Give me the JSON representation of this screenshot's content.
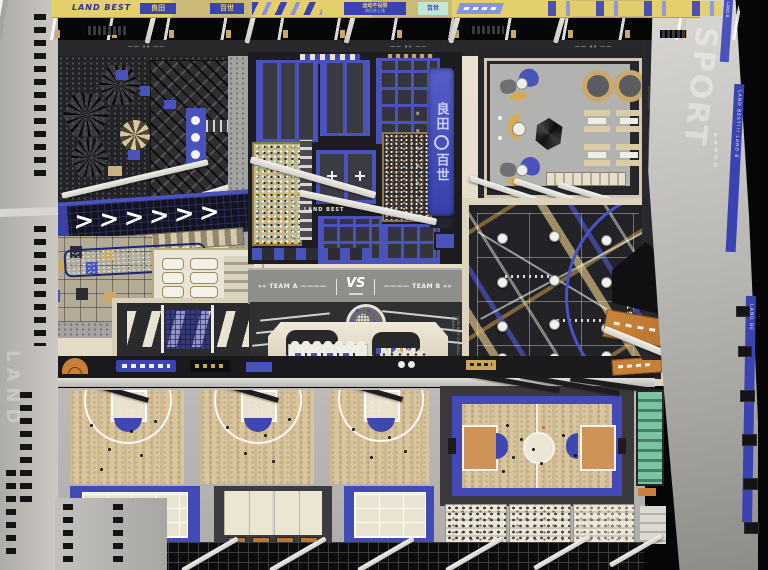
{
  "palette": {
    "accent_blue": "#4a52bc",
    "banner_yellow": "#e3cf6b",
    "dark": "#232327",
    "beige": "#e7dfcb",
    "wood": "#d9c69e",
    "concrete": "#b7b6b4",
    "wall_grey": "#c6c4c0",
    "court_blue": "#434ab8",
    "key_orange": "#cf9257",
    "mat_green": "#7cc4a0",
    "led_navy": "#13131d"
  },
  "ceiling": {
    "brand": "LAND BEST",
    "sign_liangtian": "良田",
    "sign_baishi": "百世",
    "slogan_main": "运动不设限",
    "slogan_sub": "快乐先上场",
    "sign_baishi_small": "百世"
  },
  "marks": {
    "dash_chevron": "——  »»  ——",
    "led_chevrons": ">>>>>>",
    "up_chevrons": "« « « « « «",
    "wall_chevrons": "»»»»»"
  },
  "trampoline": {
    "floor_brand": "LAND BEST",
    "banner_top": "良田",
    "banner_bottom": "百世"
  },
  "team_strip": {
    "team_a": "«« TEAM A ————",
    "vs": "VS",
    "team_b": "———— TEAM B »»"
  },
  "ropes": {
    "start": "START"
  },
  "stage": {
    "side_text": "LAND BEST CULTURAL TOURISM"
  },
  "right_wall": {
    "big_word": "SPORT",
    "stripe_top": "LAND B",
    "stripe_mid": "LAND BEST!!! LAND B",
    "stripe_bottom": "LAND BE"
  },
  "left_wall": {
    "ghost": "LAND"
  }
}
